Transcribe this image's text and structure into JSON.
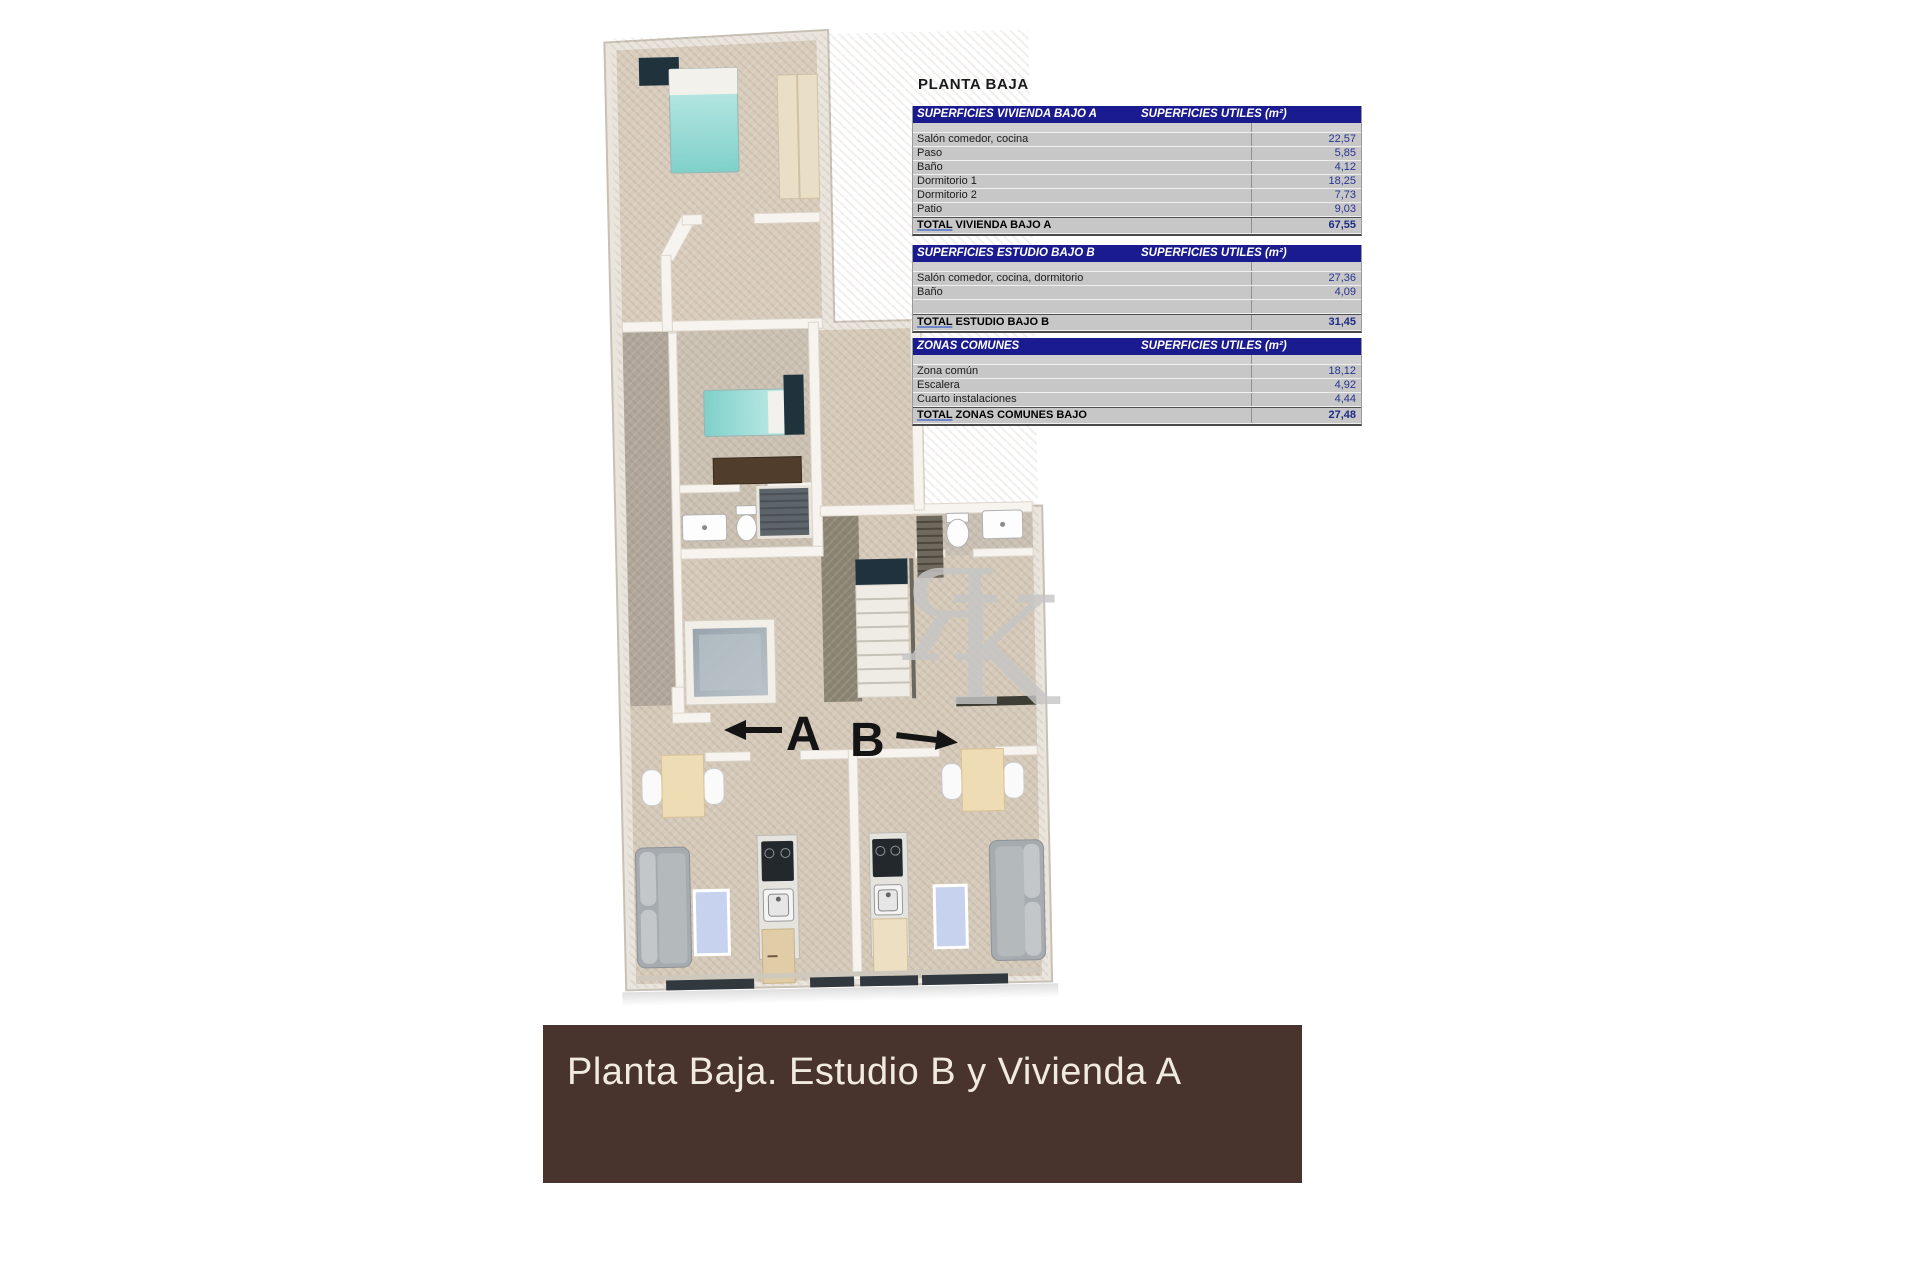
{
  "page": {
    "title": "PLANTA BAJA"
  },
  "tables": [
    {
      "header_left": "SUPERFICIES VIVIENDA BAJO A",
      "header_right": "SUPERFICIES UTILES  (m²)",
      "rows": [
        {
          "label": "Salón comedor, cocina",
          "value": "22,57"
        },
        {
          "label": "Paso",
          "value": "5,85"
        },
        {
          "label": "Baño",
          "value": "4,12"
        },
        {
          "label": "Dormitorio 1",
          "value": "18,25"
        },
        {
          "label": "Dormitorio 2",
          "value": "7,73"
        },
        {
          "label": "Patio",
          "value": "9,03"
        }
      ],
      "total_label": "TOTAL VIVIENDA BAJO A",
      "total_value": "67,55"
    },
    {
      "header_left": "SUPERFICIES ESTUDIO BAJO B",
      "header_right": "SUPERFICIES UTILES  (m²)",
      "rows": [
        {
          "label": "Salón comedor, cocina, dormitorio",
          "value": "27,36"
        },
        {
          "label": "Baño",
          "value": "4,09"
        },
        {
          "label": "",
          "value": ""
        }
      ],
      "total_label": "TOTAL ESTUDIO BAJO B",
      "total_value": "31,45"
    },
    {
      "header_left": "ZONAS COMUNES",
      "header_right": "SUPERFICIES UTILES  (m²)",
      "rows": [
        {
          "label": "Zona común",
          "value": "18,12"
        },
        {
          "label": "Escalera",
          "value": "4,92"
        },
        {
          "label": "Cuarto instalaciones",
          "value": "4,44"
        }
      ],
      "total_label": "TOTAL ZONAS COMUNES BAJO",
      "total_value": "27,48"
    }
  ],
  "floorplan": {
    "unit_a_label": "A",
    "unit_b_label": "B",
    "watermark_r": "Я",
    "watermark_k": "K"
  },
  "banner": {
    "text": "Planta Baja. Estudio B y Vivienda A"
  },
  "colors": {
    "banner_bg": "#48342c",
    "banner_fg": "#f1eae1",
    "table_header_bg": "#1b1b90",
    "table_row_bg": "#c7c7c7",
    "value_text": "#273390"
  }
}
